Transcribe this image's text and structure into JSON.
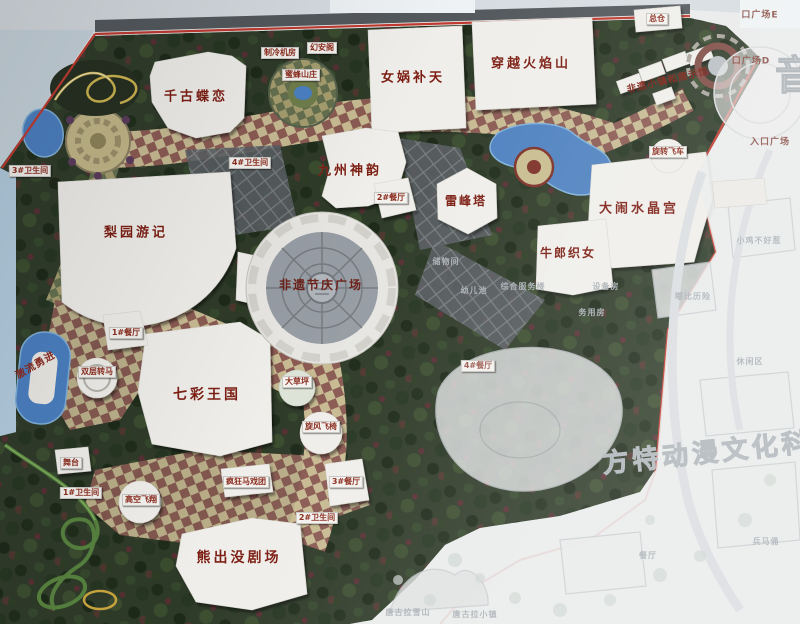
{
  "map_board": {
    "type": "theme-park master-plan photo",
    "watermark": "方特动漫文化科技",
    "corner_glyph": "音"
  },
  "attractions": [
    {
      "name": "千古蝶恋"
    },
    {
      "name": "女娲补天"
    },
    {
      "name": "穿越火焰山"
    },
    {
      "name": "九州神韵"
    },
    {
      "name": "雷峰塔"
    },
    {
      "name": "大闹水晶宫"
    },
    {
      "name": "牛郎织女"
    },
    {
      "name": "梨园游记"
    },
    {
      "name": "非遗节庆广场"
    },
    {
      "name": "七彩王国"
    },
    {
      "name": "熊出没剧场"
    },
    {
      "name": "激流勇进"
    },
    {
      "name": "非遗小镇和展示馆"
    }
  ],
  "facilities": [
    {
      "name": "1#餐厅"
    },
    {
      "name": "双层转马"
    },
    {
      "name": "舞台"
    },
    {
      "name": "高空飞翔"
    },
    {
      "name": "疯狂马戏团"
    },
    {
      "name": "3#餐厅"
    },
    {
      "name": "旋风飞椅"
    },
    {
      "name": "大草坪"
    },
    {
      "name": "2#餐厅"
    },
    {
      "name": "总仓"
    },
    {
      "name": "旋转飞车"
    },
    {
      "name": "1#卫生间"
    },
    {
      "name": "2#卫生间"
    },
    {
      "name": "3#卫生间"
    },
    {
      "name": "4#卫生间"
    },
    {
      "name": "制冷机房"
    },
    {
      "name": "幻安阁"
    },
    {
      "name": "蜜蜂山庄"
    },
    {
      "name": "4#餐厅"
    }
  ],
  "entrances": [
    {
      "name": "口广场E"
    },
    {
      "name": "口广场D"
    },
    {
      "name": "入口广场"
    }
  ],
  "faint_areas": [
    {
      "name": "储物间"
    },
    {
      "name": "幼儿池"
    },
    {
      "name": "综合服务楼"
    },
    {
      "name": "设备房"
    },
    {
      "name": "务用房"
    },
    {
      "name": "小鸡不好惹"
    },
    {
      "name": "嘟比历险"
    },
    {
      "name": "休闲区"
    },
    {
      "name": "兵马俑"
    },
    {
      "name": "餐厅"
    },
    {
      "name": "唐古拉雪山"
    },
    {
      "name": "唐古拉小镇"
    }
  ],
  "colors": {
    "boundary_red": "#c0392e",
    "label_red": "#7c1d12",
    "water_blue": "#4a7fc1",
    "park_green": "#2e3a28",
    "tile_light": "#c7ba92",
    "tile_dark": "#8a5a52",
    "faded_area": "#e9eaea"
  }
}
